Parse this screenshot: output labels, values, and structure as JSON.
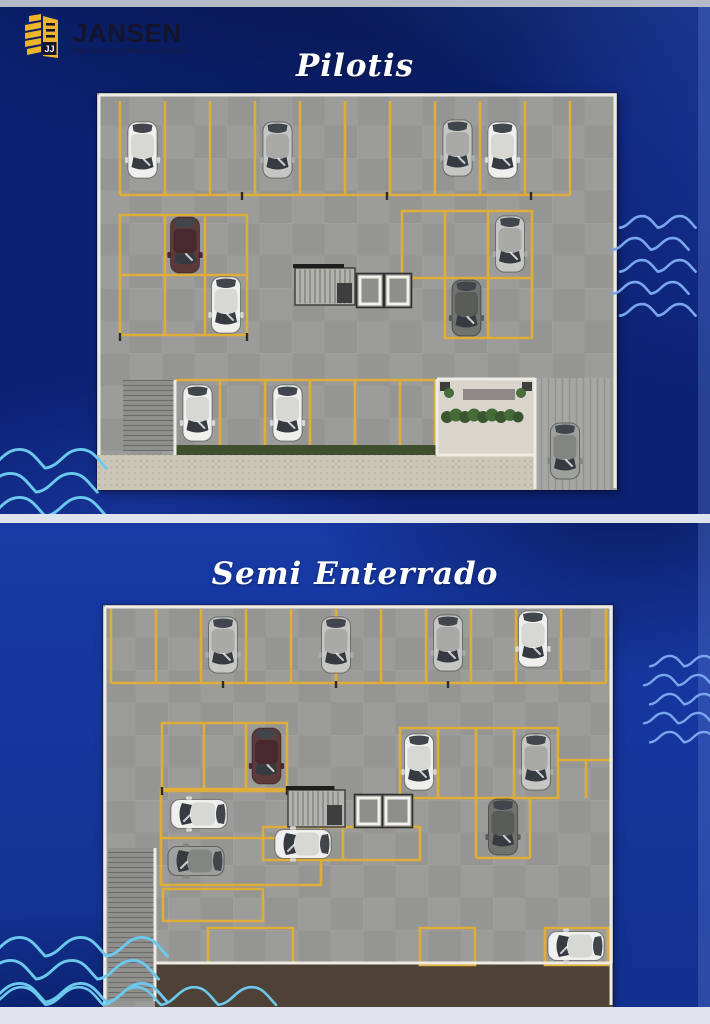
{
  "brand": {
    "name": "JANSEN",
    "subtitle": "NEGÓCIOS IMOBILIÁRIOS",
    "icon_letters": "JJ"
  },
  "sections": [
    {
      "id": "pilotis",
      "title": "Pilotis"
    },
    {
      "id": "semi-enterrado",
      "title": "Semi Enterrado"
    }
  ],
  "colors": {
    "navy": "#0c2173",
    "royal": "#16379f",
    "strip": "#dfe3ee",
    "wave_blue": "#7aa6ee",
    "wave_cyan": "#6cc8ec",
    "brand_yellow": "#f0b42c",
    "brand_text": "#14142c",
    "stall_yellow": "#dfae38",
    "floor_gray": "#9c9c9a",
    "title_white": "#ffffff"
  },
  "plans": [
    {
      "name": "Pilotis",
      "w": 520,
      "h": 397,
      "rects": [
        {
          "x": 0,
          "y": 0,
          "w": 520,
          "h": 397,
          "f": "floor",
          "o": "tile"
        },
        {
          "x": 0,
          "y": 362,
          "w": 440,
          "h": 35,
          "f": "sidewalk",
          "o": "dots"
        },
        {
          "x": 438,
          "y": 285,
          "w": 82,
          "h": 112,
          "f": "driveway",
          "o": "hatchV"
        },
        {
          "x": 340,
          "y": 286,
          "w": 98,
          "h": 76,
          "f": "lobby"
        },
        {
          "x": 78,
          "y": 352,
          "w": 262,
          "h": 10,
          "f": "grass"
        },
        {
          "x": 26,
          "y": 287,
          "w": 52,
          "h": 71,
          "f": "ramp",
          "o": "hatchH"
        },
        {
          "x": 366,
          "y": 296,
          "w": 52,
          "h": 11,
          "f": "bench"
        },
        {
          "x": 343,
          "y": 289,
          "w": 10,
          "h": 9,
          "f": "dark_sq"
        },
        {
          "x": 425,
          "y": 289,
          "w": 10,
          "h": 9,
          "f": "dark_sq"
        }
      ],
      "paths": [
        {
          "d": "M23,8V102 M68,8V102 M113,8V102 M158,8V102 M203,8V102 M248,8V102 M293,8V102 M338,8V102 M383,8V102 M428,8V102 M473,8V102 M23,102H473",
          "s": "stall"
        },
        {
          "d": "M23,122H150V242H23Z M68,122V242 M108,122V242 M23,182H150",
          "s": "stall"
        },
        {
          "d": "M305,118H435V245H348V185H305Z M348,118V185 M391,118V245 M348,185H435",
          "s": "stall"
        },
        {
          "d": "M78,287H338 M78,287V352 M123,287V352 M168,287V352 M213,287V352 M258,287V352 M303,287V352 M338,287V352",
          "s": "stall"
        },
        {
          "d": "M2,2H518V395 M2,2V362",
          "s": "wall"
        },
        {
          "d": "M340,286H438 M340,286V362 M340,362H438 M438,285V396 M78,287V362",
          "s": "wall"
        },
        {
          "d": "M145,99V107 M290,99V107 M434,99V107 M23,240V248 M150,240V248",
          "s": "dark"
        }
      ],
      "stairs": {
        "x": 198,
        "y": 175,
        "w": 60,
        "h": 37
      },
      "elevators": [
        {
          "x": 262,
          "y": 183,
          "w": 22,
          "h": 29
        },
        {
          "x": 290,
          "y": 183,
          "w": 22,
          "h": 29
        }
      ],
      "circles": [
        {
          "x": 350,
          "y": 324,
          "r": 6,
          "f": "#3a5631"
        },
        {
          "x": 359,
          "y": 322,
          "r": 6.5,
          "f": "#456b39"
        },
        {
          "x": 368,
          "y": 324,
          "r": 6,
          "f": "#3a5631"
        },
        {
          "x": 377,
          "y": 322,
          "r": 6.5,
          "f": "#456b39"
        },
        {
          "x": 386,
          "y": 324,
          "r": 6,
          "f": "#3a5631"
        },
        {
          "x": 395,
          "y": 322,
          "r": 6.5,
          "f": "#456b39"
        },
        {
          "x": 404,
          "y": 324,
          "r": 6,
          "f": "#3a5631"
        },
        {
          "x": 413,
          "y": 322,
          "r": 6,
          "f": "#456b39"
        },
        {
          "x": 421,
          "y": 324,
          "r": 5.5,
          "f": "#3a5631"
        },
        {
          "x": 352,
          "y": 300,
          "r": 5,
          "f": "#4a6b3c"
        },
        {
          "x": 424,
          "y": 300,
          "r": 5,
          "f": "#4a6b3c"
        }
      ],
      "cars": [
        {
          "x": 45.5,
          "y": 57,
          "r": 180,
          "c": "white"
        },
        {
          "x": 180.5,
          "y": 57,
          "r": 180,
          "c": "silver"
        },
        {
          "x": 360.5,
          "y": 55,
          "r": 180,
          "c": "silver"
        },
        {
          "x": 405.5,
          "y": 57,
          "r": 180,
          "c": "white"
        },
        {
          "x": 88,
          "y": 152,
          "r": 180,
          "c": "maroon"
        },
        {
          "x": 129,
          "y": 212,
          "r": 180,
          "c": "white"
        },
        {
          "x": 413,
          "y": 151,
          "r": 180,
          "c": "silver"
        },
        {
          "x": 369.5,
          "y": 215,
          "r": 180,
          "c": "dark"
        },
        {
          "x": 100.5,
          "y": 320,
          "r": 180,
          "c": "white"
        },
        {
          "x": 190.5,
          "y": 320,
          "r": 180,
          "c": "white"
        },
        {
          "x": 468,
          "y": 358,
          "r": 180,
          "c": "gray"
        }
      ]
    },
    {
      "name": "Semi Enterrado",
      "w": 510,
      "h": 402,
      "rects": [
        {
          "x": 0,
          "y": 0,
          "w": 510,
          "h": 402,
          "f": "floor",
          "o": "tile"
        },
        {
          "x": 52,
          "y": 358,
          "w": 458,
          "h": 44,
          "f": "brown"
        },
        {
          "x": 5,
          "y": 243,
          "w": 47,
          "h": 153,
          "f": "ramp",
          "o": "hatchH"
        }
      ],
      "paths": [
        {
          "d": "M8,4V78 M53,4V78 M98,4V78 M143,4V78 M188,4V78 M233,4V78 M278,4V78 M323,4V78 M368,4V78 M413,4V78 M458,4V78 M503,4V78 M8,78H503",
          "s": "stall"
        },
        {
          "d": "M59,118H184V184H59Z M101,118V184 M143,118V184",
          "s": "stall"
        },
        {
          "d": "M58,186H218V280H58Z M58,233H218",
          "s": "stall"
        },
        {
          "d": "M60,284H160V316H60Z M105,323H190V358H105Z",
          "s": "stall"
        },
        {
          "d": "M160,222H317V255H160Z M240,222V255",
          "s": "stall"
        },
        {
          "d": "M297,123H455V193H297Z M335,123V193 M373,123V193 M411,123V193",
          "s": "stall"
        },
        {
          "d": "M373,193V253 M427,193V253 M373,253H427 M483,155V193 M455,155H510",
          "s": "stall"
        },
        {
          "d": "M317,323H372V360H317Z M442,323H505V360H442Z",
          "s": "stall"
        },
        {
          "d": "M2,2H508V400 M2,2V400",
          "s": "wall"
        },
        {
          "d": "M52,243V396 M52,358H508",
          "s": "wall"
        },
        {
          "d": "M120,76V83 M233,76V83 M345,76V83 M59,182V190 M184,182V190",
          "s": "dark"
        }
      ],
      "stairs": {
        "x": 185,
        "y": 185,
        "w": 57,
        "h": 37
      },
      "elevators": [
        {
          "x": 254,
          "y": 192,
          "w": 23,
          "h": 28
        },
        {
          "x": 282,
          "y": 192,
          "w": 25,
          "h": 28
        }
      ],
      "circles": [],
      "cars": [
        {
          "x": 120,
          "y": 40,
          "r": 180,
          "c": "silver"
        },
        {
          "x": 233,
          "y": 40,
          "r": 180,
          "c": "silver"
        },
        {
          "x": 345,
          "y": 38,
          "r": 180,
          "c": "silver"
        },
        {
          "x": 430,
          "y": 34,
          "r": 180,
          "c": "white"
        },
        {
          "x": 163.5,
          "y": 151,
          "r": 180,
          "c": "maroon"
        },
        {
          "x": 96,
          "y": 209,
          "r": -90,
          "c": "white"
        },
        {
          "x": 93,
          "y": 256,
          "r": -90,
          "c": "gray"
        },
        {
          "x": 200,
          "y": 239,
          "r": -90,
          "c": "white"
        },
        {
          "x": 316,
          "y": 157,
          "r": 180,
          "c": "white"
        },
        {
          "x": 433,
          "y": 157,
          "r": 180,
          "c": "silver"
        },
        {
          "x": 400,
          "y": 222,
          "r": 180,
          "c": "dark"
        },
        {
          "x": 473,
          "y": 341,
          "r": -90,
          "c": "white"
        }
      ]
    }
  ],
  "decorations": {
    "waves": [
      {
        "x": 620,
        "y": 214,
        "rows": 5,
        "spacing": 22,
        "humps": 2,
        "scale": 1.05,
        "stagger": 7,
        "color": "wave_blue",
        "width": 2.6
      },
      {
        "x": -16,
        "y": 446,
        "rows": 3,
        "spacing": 24,
        "humps": 2,
        "scale": 1.7,
        "stagger": 9,
        "color": "wave_cyan",
        "width": 2.9
      },
      {
        "x": 650,
        "y": 654,
        "rows": 5,
        "spacing": 19,
        "humps": 2,
        "scale": 0.95,
        "stagger": 6,
        "color": "wave_blue",
        "width": 2.4
      },
      {
        "x": -16,
        "y": 934,
        "rows": 3,
        "spacing": 23,
        "humps": 3,
        "scale": 1.7,
        "stagger": 9,
        "color": "wave_cyan",
        "width": 2.9
      },
      {
        "x": -12,
        "y": 984,
        "rows": 1,
        "spacing": 0,
        "humps": 5,
        "scale": 1.6,
        "stagger": 0,
        "color": "wave_cyan",
        "width": 2.6
      }
    ]
  }
}
